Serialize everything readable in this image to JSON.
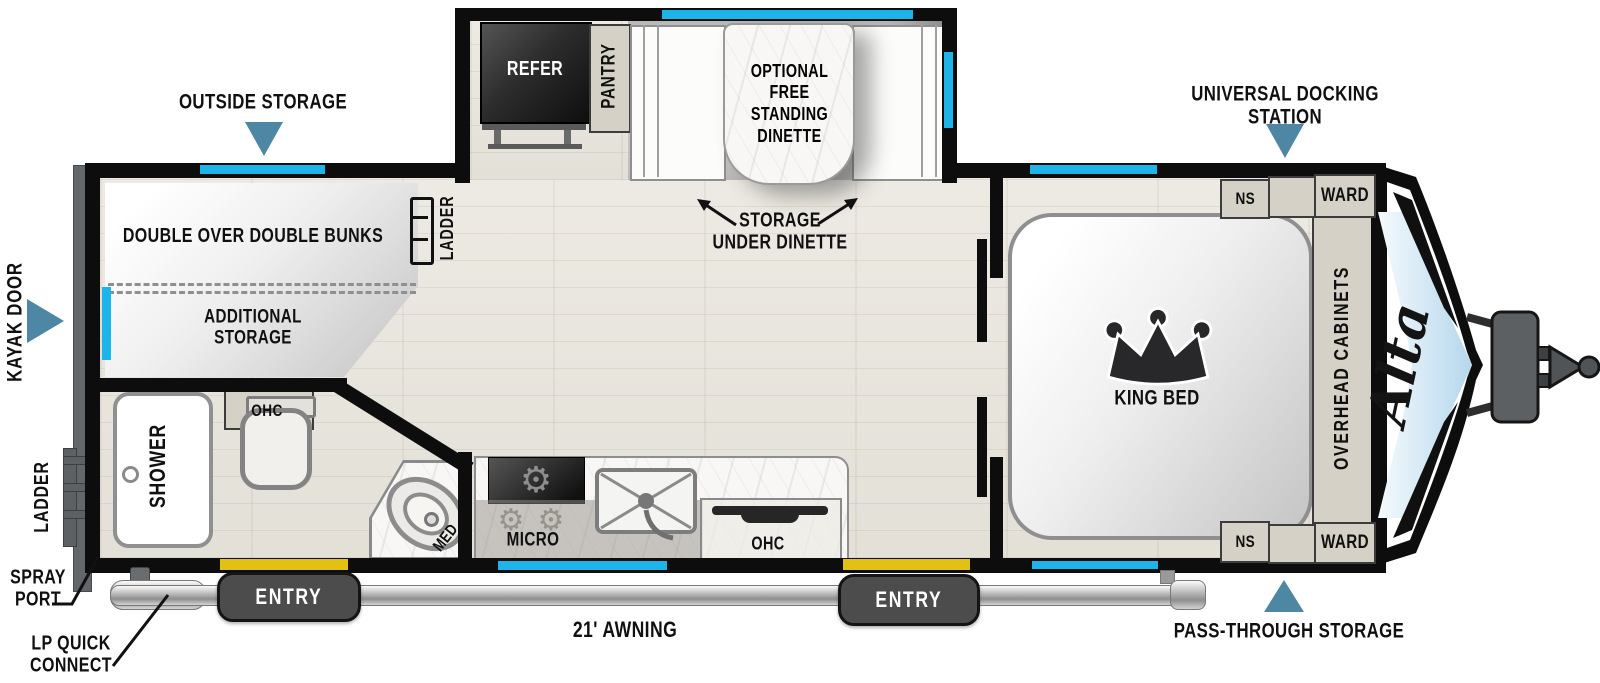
{
  "colors": {
    "window": "#1db5e9",
    "marker": "#4e87a3",
    "entry_door": "#e3c112",
    "wall": "#0d0d0d",
    "cabinet": "#d5d1c7"
  },
  "icons": {
    "burner": "⚙"
  },
  "brand": {
    "model": "Alta"
  },
  "exterior": {
    "outside_storage": "OUTSIDE STORAGE",
    "universal_docking_station": "UNIVERSAL DOCKING STATION",
    "pass_through_storage": "PASS-THROUGH STORAGE",
    "kayak_door": "KAYAK DOOR",
    "rear_ladder": "LADDER",
    "spray_port": "SPRAY\nPORT",
    "lp_quick_connect": "LP QUICK\nCONNECT",
    "awning": "21' AWNING",
    "entry_rear": "ENTRY",
    "entry_front": "ENTRY"
  },
  "interior": {
    "bunks": "DOUBLE OVER DOUBLE BUNKS",
    "additional_storage": "ADDITIONAL\nSTORAGE",
    "bunk_ladder": "LADDER",
    "shower": "SHOWER",
    "bath_ohc": "OHC",
    "med": "MED",
    "refer": "REFER",
    "pantry": "PANTRY",
    "dinette": "OPTIONAL\nFREE\nSTANDING\nDINETTE",
    "storage_under_dinette": "STORAGE\nUNDER DINETTE",
    "micro": "MICRO",
    "kitchen_ohc": "OHC",
    "king_bed": "KING BED",
    "overhead_cabinets": "OVERHEAD CABINETS",
    "ns_top": "NS",
    "ns_bottom": "NS",
    "ward_top": "WARD",
    "ward_bottom": "WARD"
  }
}
